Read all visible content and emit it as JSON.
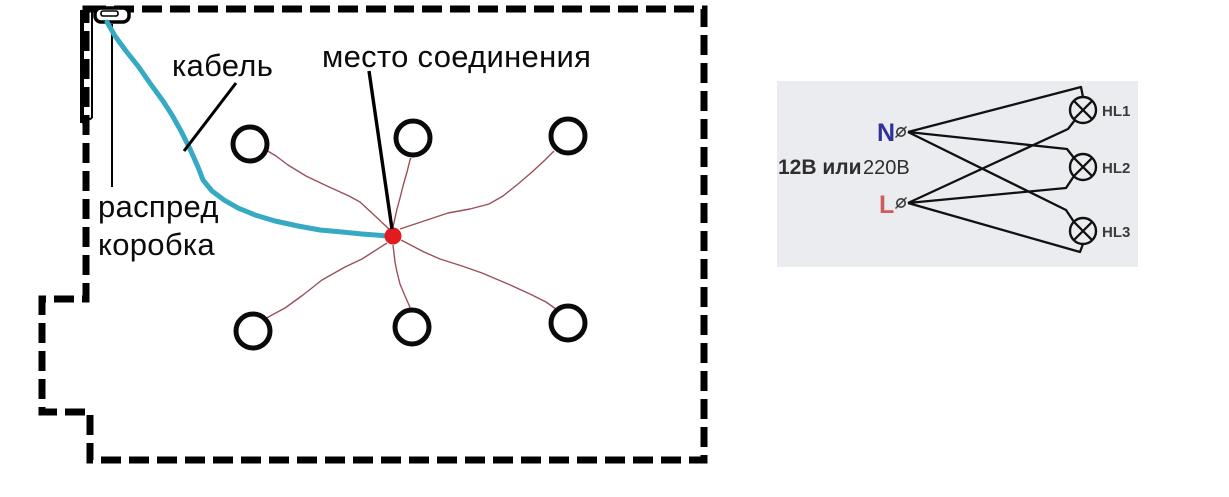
{
  "floorplan": {
    "label_cable": "кабель",
    "label_junction": "место соединения",
    "label_box_line1": "распред",
    "label_box_line2": "коробка",
    "spotlight_count": 6,
    "colors": {
      "cable": "#36a9c3",
      "junction_dot": "#e11b1e",
      "fixture_wire": "#9b4f5a",
      "outline": "#000000"
    }
  },
  "schematic": {
    "voltage_bold": "12В или",
    "voltage_regular": "220В",
    "neutral_label": "N",
    "line_label": "L",
    "lamps": [
      {
        "label": "HL1"
      },
      {
        "label": "HL2"
      },
      {
        "label": "HL3"
      }
    ],
    "colors": {
      "neutral": "#31319b",
      "line": "#cf5b5b",
      "panel_background": "#ebecf0",
      "wire": "#111111"
    }
  }
}
